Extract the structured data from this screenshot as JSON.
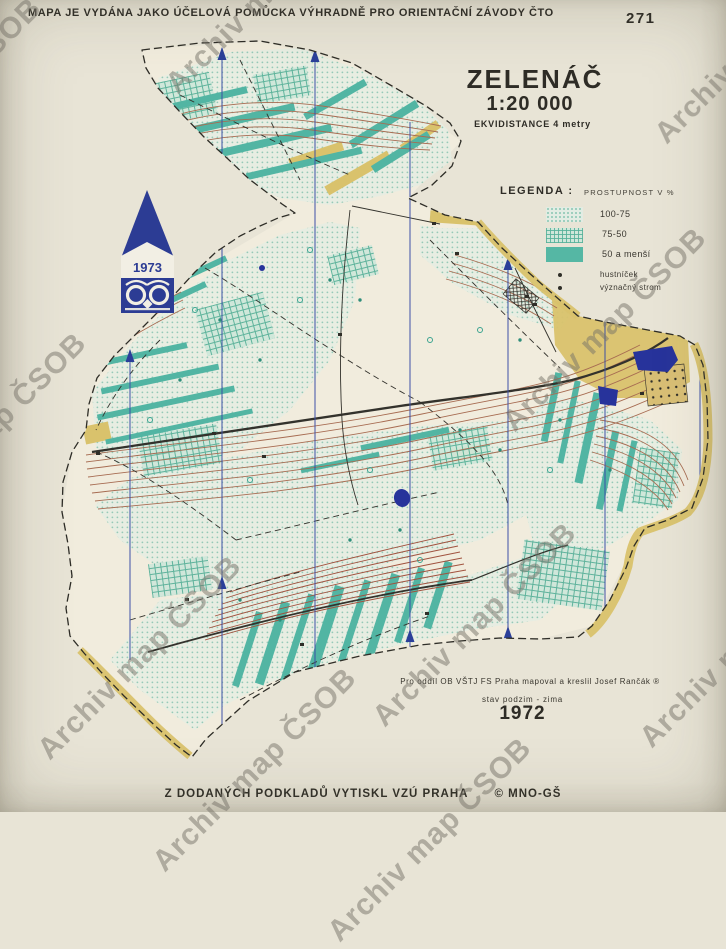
{
  "page": {
    "background": "#e8e4d6"
  },
  "header": {
    "disclaimer": "MAPA JE VYDÁNA JAKO ÚČELOVÁ POMŮCKA VÝHRADNĚ PRO ORIENTAČNÍ ZÁVODY ČTO",
    "map_number": "271"
  },
  "title_block": {
    "title": "ZELENÁČ",
    "scale": "1:20 000",
    "equidistance": "EKVIDISTANCE 4 metry"
  },
  "legend": {
    "label": "LEGENDA :",
    "header": "PROSTUPNOST V %",
    "items": [
      {
        "label": "100-75",
        "swatch": "dots-light"
      },
      {
        "label": "75-50",
        "swatch": "grid-medium"
      },
      {
        "label": "50 a menší",
        "swatch": "solid-teal"
      },
      {
        "label": "hustníček",
        "swatch": "dot"
      },
      {
        "label": "význačný strom",
        "swatch": "dot"
      }
    ]
  },
  "emblem": {
    "year": "1973"
  },
  "credits": {
    "line1": "Pro oddíl OB VŠTJ FS Praha mapoval a kreslil Josef Rančák ®",
    "line2": "stav podzim - zima",
    "year": "1972"
  },
  "imprint": {
    "text": "Z DODANÝCH PODKLADŮ VYTISKL VZÚ PRAHA",
    "copyright": "© MNO-GŠ"
  },
  "watermark": {
    "text": "Archiv map ČSOB"
  },
  "colors": {
    "paper": "#e8e4d6",
    "map_cream": "#f1ecdd",
    "vegetation_teal": "#52b5a3",
    "open_yellow": "#d9c26c",
    "contour_brown": "#a76c52",
    "line_black": "#33322c",
    "north_blue": "#3c50a6",
    "water_blue": "#27339b",
    "emblem_blue": "#2c3c94",
    "watermark_gray": "#8e8b80"
  }
}
